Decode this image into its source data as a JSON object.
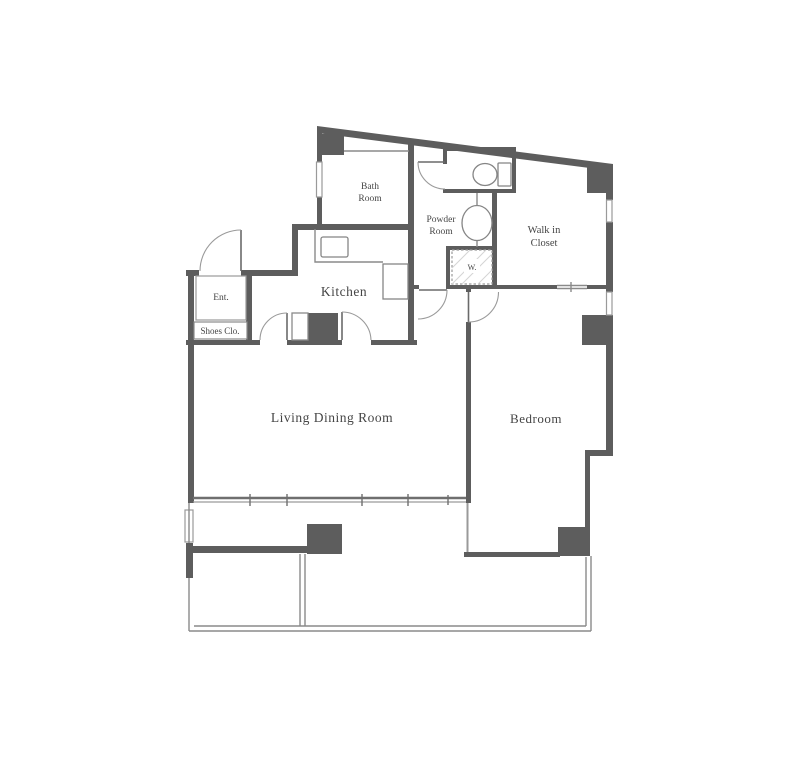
{
  "title": "apartment-floor-plan",
  "rooms": {
    "bath": {
      "line1": "Bath",
      "line2": "Room"
    },
    "powder": {
      "line1": "Powder",
      "line2": "Room"
    },
    "walk_in_closet": {
      "line1": "Walk in",
      "line2": "Closet"
    },
    "kitchen": {
      "label": "Kitchen"
    },
    "entrance": {
      "label": "Ent."
    },
    "shoes_closet": {
      "label": "Shoes Clo."
    },
    "living_dining": {
      "label": "Living Dining Room"
    },
    "bedroom": {
      "label": "Bedroom"
    },
    "washer": {
      "label": "W."
    }
  },
  "colors": {
    "wall": "#5d5d5d",
    "thin_line": "#8a8a8a",
    "window": "#9a9a9a",
    "text": "#454545",
    "background": "#ffffff"
  }
}
